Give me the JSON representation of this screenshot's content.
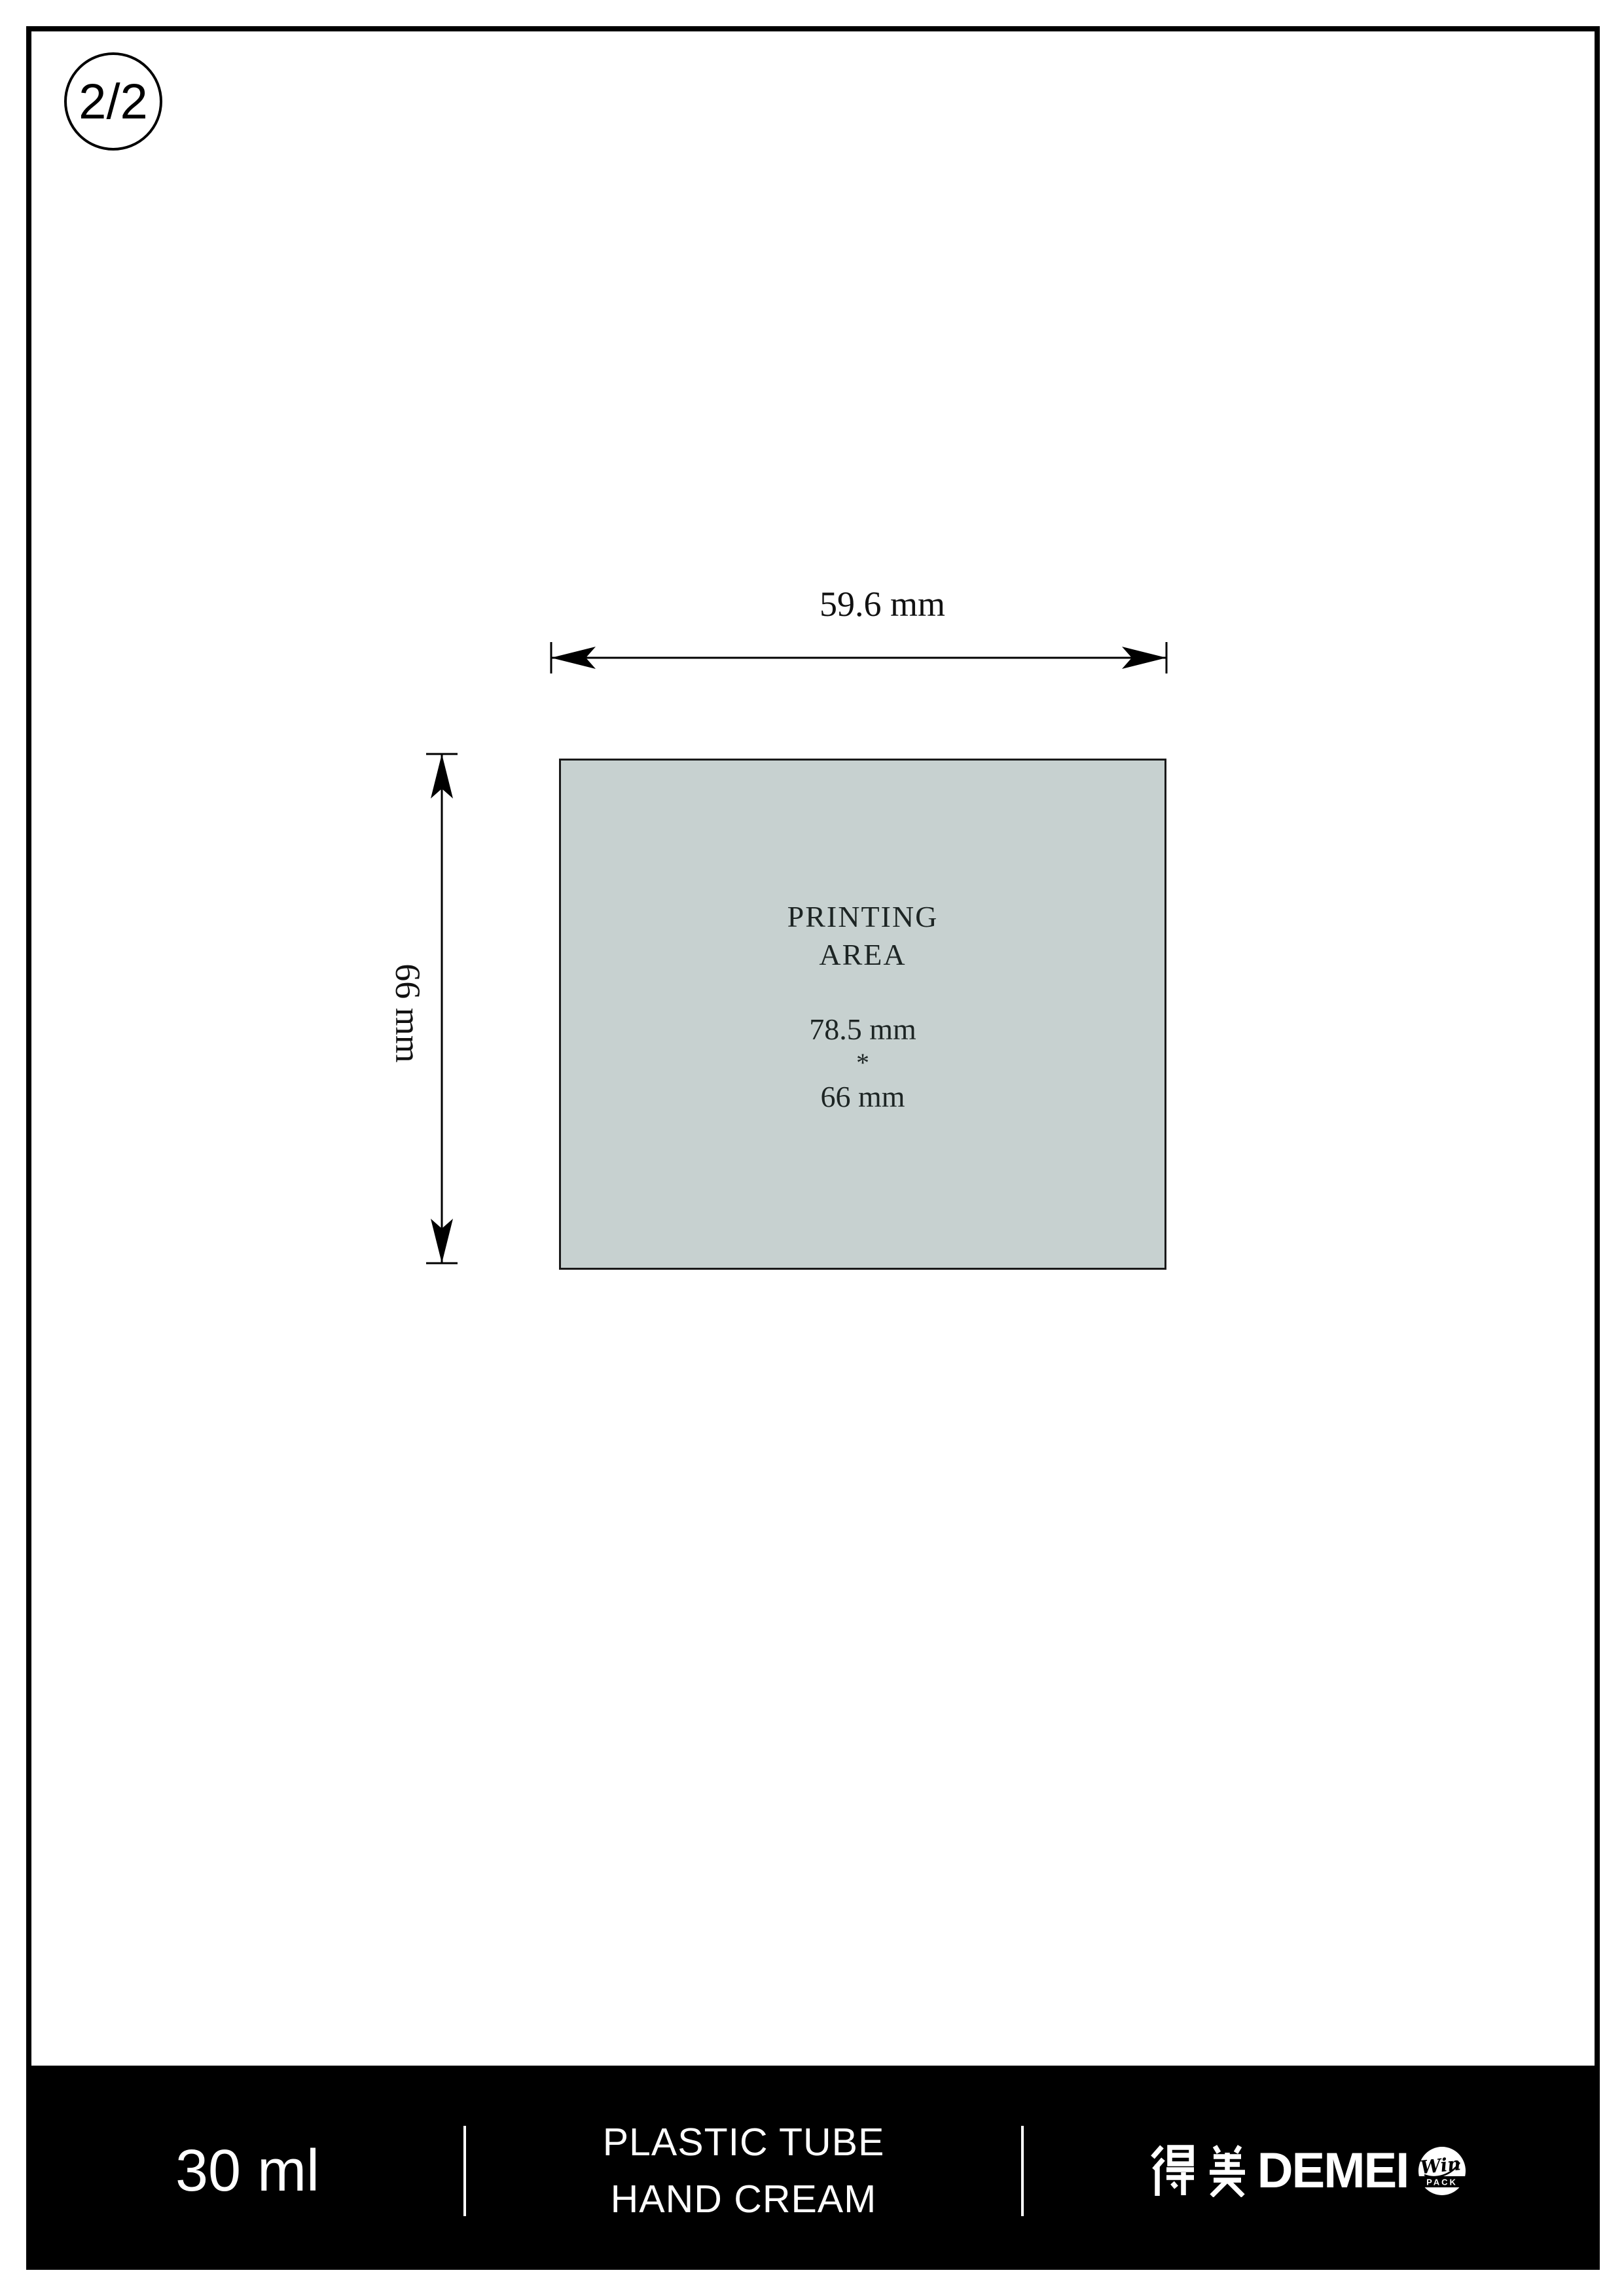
{
  "page": {
    "indicator": "2/2"
  },
  "drawing": {
    "width_label": "59.6 mm",
    "height_label": "66 mm",
    "printing_area": {
      "title_line1": "PRINTING",
      "title_line2": "AREA",
      "dim_width": "78.5 mm",
      "dim_separator": "*",
      "dim_height": "66 mm",
      "fill_color": "#c7d1d0"
    }
  },
  "footer": {
    "volume": "30 ml",
    "product_line1": "PLASTIC TUBE",
    "product_line2": "HAND CREAM",
    "bar_color": "#000000",
    "logo": {
      "chinese": "得美",
      "latin": "DEMEI",
      "badge_line1": "Win",
      "badge_line2": "PACK"
    }
  }
}
